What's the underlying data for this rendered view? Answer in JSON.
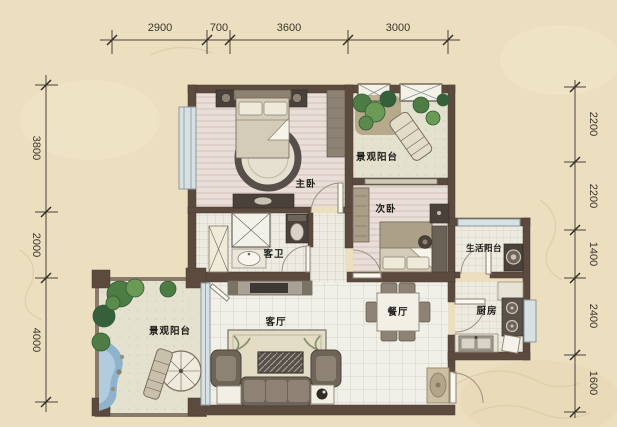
{
  "dimensions": {
    "top": [
      "2900",
      "700",
      "3600",
      "3000"
    ],
    "left": [
      "3800",
      "2000",
      "4000"
    ],
    "right": [
      "2200",
      "2200",
      "1400",
      "2400",
      "1600"
    ]
  },
  "rooms": {
    "master_bedroom": "主卧",
    "second_bedroom": "次卧",
    "guest_bath": "客卫",
    "living_room": "客厅",
    "dining_room": "餐厅",
    "kitchen": "厨房",
    "utility_balcony": "生活阳台",
    "view_balcony_upper": "景观阳台",
    "view_balcony_lower": "景观阳台"
  },
  "colors": {
    "background": "#ecdfc0",
    "wall": "#5d4a3f",
    "floor_wood": "#e9dfd8",
    "floor_tile": "#f1f0e8",
    "balcony_floor": "#e4e2cf",
    "plant_green": "#4d7c44",
    "water_blue": "#8fb3cc",
    "window_glass": "#d7e0e2",
    "dimension_text": "#3b352c"
  }
}
